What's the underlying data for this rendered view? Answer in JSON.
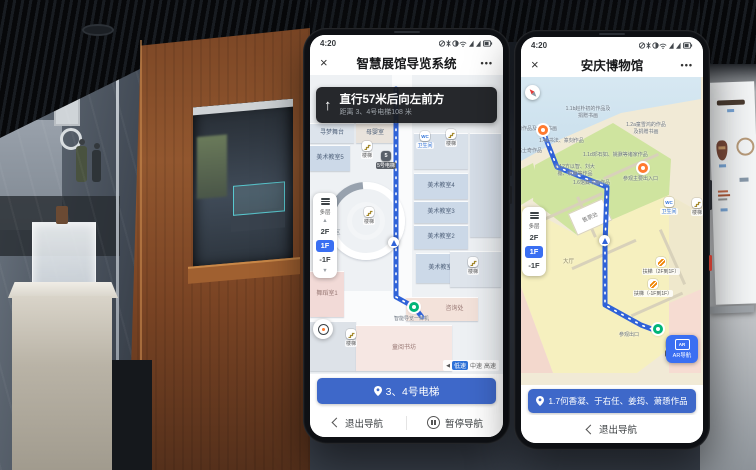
{
  "icons": {
    "close": "×",
    "more": "•••",
    "up_arrow": "↑",
    "speaker": "◀",
    "signal_cluster": "mute-icon bluetooth-icon data-saver-icon wifi-icon signal-icon battery-icon"
  },
  "colors": {
    "accent_blue": "#3E68C9",
    "route_blue": "#2F62D8",
    "active_floor_blue": "#3A6FF2",
    "banner_black": "#191B1F",
    "start_green": "#00B578",
    "marker_orange": "#FF7A2F"
  },
  "phone1": {
    "status_time": "4:20",
    "header": {
      "title": "智慧展馆导览系统"
    },
    "banner": {
      "instruction": "直行57米后向左前方",
      "distance": "距离 3、4号电梯108 米"
    },
    "floor_selector": {
      "multi": "多层",
      "floors": [
        "2F",
        "1F",
        "-1F"
      ],
      "active": "1F"
    },
    "map": {
      "rooms": [
        "寻梦舞台",
        "母婴室",
        "美术教室5",
        "美术教室4",
        "美术教室3",
        "美术教室2",
        "美术教室1",
        "培训区",
        "舞蹈室1",
        "咨询处",
        "童阅书坊"
      ],
      "pois": [
        "楼梯",
        "5号电梯",
        "卫生间",
        "楼梯",
        "楼梯",
        "楼梯",
        "楼梯",
        "智能导览一体机"
      ]
    },
    "speed": {
      "options": [
        "低速",
        "中速",
        "高速"
      ],
      "active": "低速"
    },
    "destination": "3、4号电梯",
    "actions": {
      "exit": "退出导航",
      "pause": "暂停导航"
    }
  },
  "phone2": {
    "status_time": "4:20",
    "header": {
      "title": "安庆博物馆"
    },
    "floor_selector": {
      "multi": "多层",
      "floors": [
        "2F",
        "1F",
        "-1F"
      ],
      "active": "1F"
    },
    "map": {
      "labels": [
        "1.1b赵朴初的作品及捐赠书画",
        "1.2a童雪鸿的作品及捐赠书画",
        "的作品及捐赠书画",
        "1.4b书法、篆刻作品",
        "1.1d邓石如、姚鼐等诸家作品",
        "1.12方以智、刘大櫆、姚鼐等作品",
        "1.6馆藏书画作品",
        "高士奇作品",
        "售票处",
        "大厅",
        "参观主要出入口",
        "卫生间",
        "楼梯",
        "扶梯（2F到1F）",
        "扶梯（-1F到1F）",
        "参观出口",
        "电梯"
      ]
    },
    "ar_button": "AR导航",
    "destination": "1.7何香凝、于右任、姜筠、萧愻作品",
    "actions": {
      "exit": "退出导航"
    }
  }
}
